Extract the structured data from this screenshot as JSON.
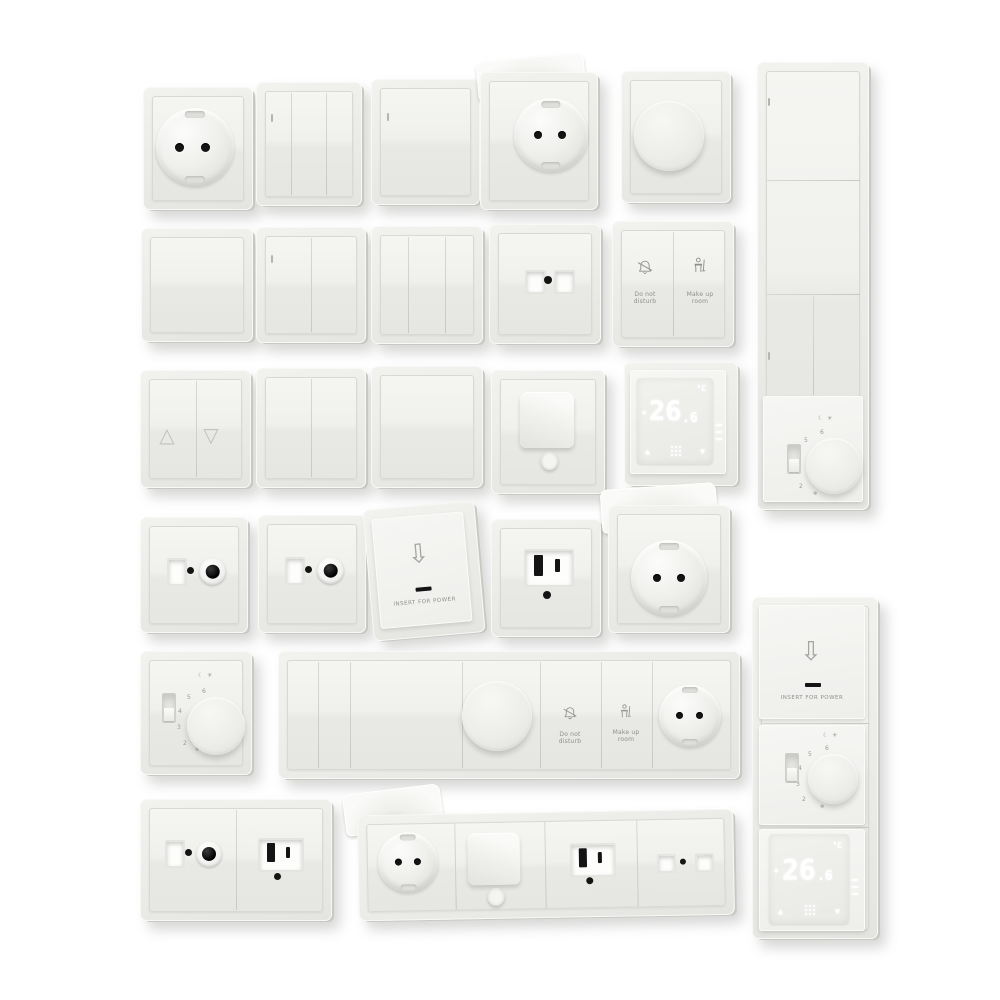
{
  "colors": {
    "background": "#ffffff",
    "plate": "#ebebe8",
    "plate_edge": "#c9c9c4",
    "engraving": "#8f8f8a",
    "contact_hole": "#141414",
    "display_glow": "#ffffff"
  },
  "glyphs": {
    "shutter_up": "△",
    "shutter_down": "▽",
    "temp_up": "▲",
    "temp_down": "▼",
    "card_arrow": "⇩",
    "night": "☾",
    "day": "☀",
    "frost": "❄"
  },
  "hotel": {
    "do_not_disturb": "Do not disturb",
    "make_up_room": "Make up room"
  },
  "keycard": {
    "label": "INSERT FOR POWER"
  },
  "digital_thermostat": {
    "value": "26",
    "decimal": ".6",
    "unit": "°C"
  },
  "dial_thermostat": {
    "scale": [
      "6",
      "5",
      "4",
      "3",
      "2"
    ]
  }
}
